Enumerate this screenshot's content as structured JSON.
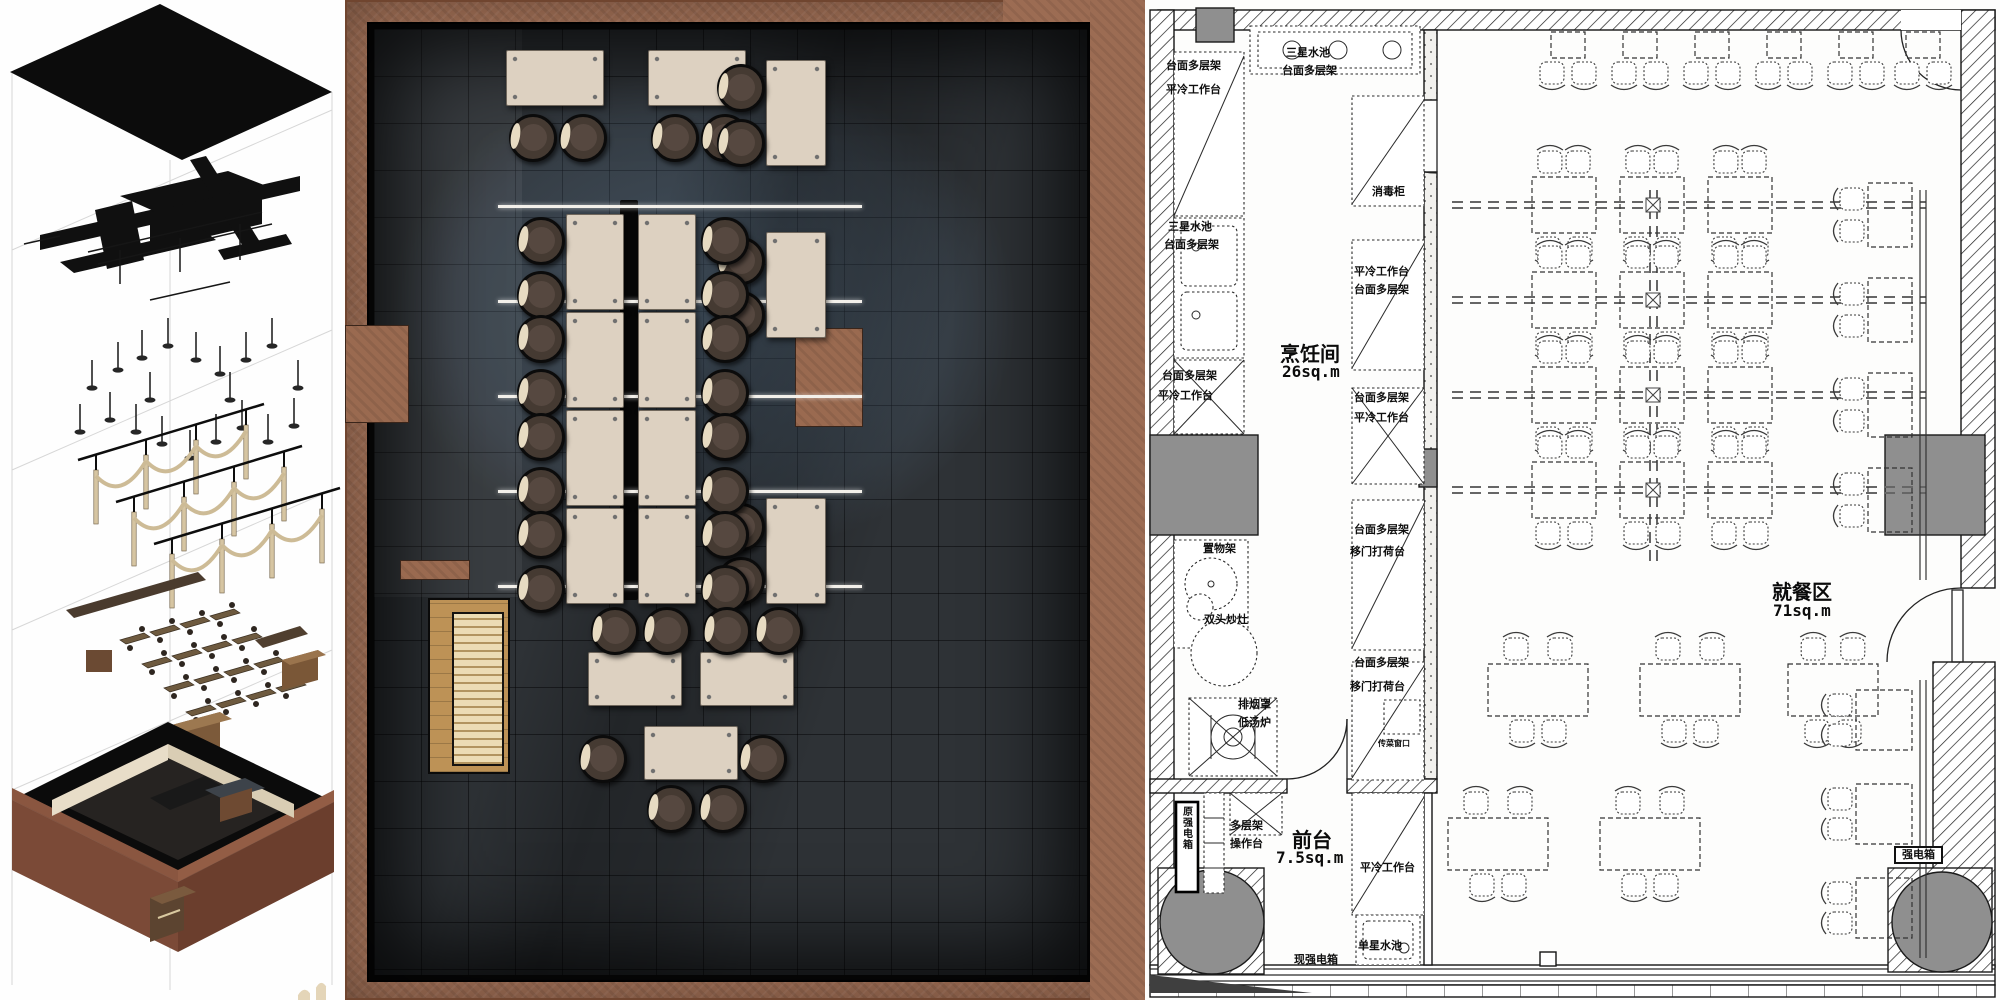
{
  "board": {
    "description": "restaurant interior design presentation: exploded axonometric, rendered floor plan, technical floor plan",
    "colors": {
      "frame_terracotta": "#9c6c53",
      "render_floor_charcoal": "#2e3236",
      "render_floor_blue": "#4a5a6b",
      "table_cream": "#ddd1c1",
      "stool_brown": "#453a32",
      "wood_floor": "#bd9256",
      "cad_line": "#1a1a1a",
      "cad_column_gray": "#8f8f8f"
    }
  },
  "panels": {
    "axon": {
      "name": "exploded-axonometric-diagram",
      "layers": [
        "ceiling-plane",
        "mep-ductwork",
        "pendant-lights",
        "timber-arch-structure",
        "furniture",
        "building-shell"
      ],
      "lights": [
        [
          92,
          360
        ],
        [
          118,
          342
        ],
        [
          142,
          330
        ],
        [
          168,
          318
        ],
        [
          196,
          332
        ],
        [
          220,
          346
        ],
        [
          246,
          332
        ],
        [
          272,
          318
        ],
        [
          110,
          392
        ],
        [
          136,
          404
        ],
        [
          162,
          416
        ],
        [
          190,
          430
        ],
        [
          216,
          414
        ],
        [
          242,
          400
        ],
        [
          268,
          414
        ],
        [
          294,
          398
        ],
        [
          150,
          372
        ],
        [
          230,
          372
        ],
        [
          80,
          404
        ],
        [
          298,
          360
        ]
      ]
    },
    "render_plan": {
      "name": "rendered-floor-plan",
      "light_lines": {
        "x1": 498,
        "x2": 862,
        "ys": [
          205,
          300,
          395,
          490,
          585
        ]
      },
      "spine_bar": {
        "x": 620,
        "y": 200,
        "w": 18,
        "h": 400
      },
      "stubs": [
        {
          "x": 345,
          "y": 325,
          "w": 62,
          "h": 96
        },
        {
          "x": 795,
          "y": 328,
          "w": 66,
          "h": 97
        },
        {
          "x": 400,
          "y": 560,
          "w": 68,
          "h": 18
        }
      ],
      "wood_zone": {
        "x": 428,
        "y": 598,
        "w": 78,
        "h": 172
      },
      "counter": {
        "x": 452,
        "y": 612,
        "w": 48,
        "h": 150
      },
      "tables": [
        {
          "x": 506,
          "y": 50,
          "w": 96,
          "h": 54
        },
        {
          "x": 648,
          "y": 50,
          "w": 96,
          "h": 54
        },
        {
          "x": 766,
          "y": 60,
          "w": 58,
          "h": 104
        },
        {
          "x": 766,
          "y": 232,
          "w": 58,
          "h": 104
        },
        {
          "x": 766,
          "y": 498,
          "w": 58,
          "h": 104
        },
        {
          "x": 566,
          "y": 214,
          "w": 56,
          "h": 94
        },
        {
          "x": 566,
          "y": 312,
          "w": 56,
          "h": 94
        },
        {
          "x": 566,
          "y": 410,
          "w": 56,
          "h": 94
        },
        {
          "x": 566,
          "y": 508,
          "w": 56,
          "h": 94
        },
        {
          "x": 638,
          "y": 214,
          "w": 56,
          "h": 94
        },
        {
          "x": 638,
          "y": 312,
          "w": 56,
          "h": 94
        },
        {
          "x": 638,
          "y": 410,
          "w": 56,
          "h": 94
        },
        {
          "x": 638,
          "y": 508,
          "w": 56,
          "h": 94
        },
        {
          "x": 588,
          "y": 652,
          "w": 92,
          "h": 52
        },
        {
          "x": 700,
          "y": 652,
          "w": 92,
          "h": 52
        },
        {
          "x": 644,
          "y": 726,
          "w": 92,
          "h": 52
        }
      ],
      "stools": [
        [
          530,
          135
        ],
        [
          580,
          135
        ],
        [
          672,
          135
        ],
        [
          722,
          135
        ],
        [
          738,
          85
        ],
        [
          738,
          140
        ],
        [
          738,
          258
        ],
        [
          738,
          312
        ],
        [
          738,
          524
        ],
        [
          738,
          578
        ],
        [
          538,
          238
        ],
        [
          538,
          292
        ],
        [
          538,
          336
        ],
        [
          538,
          390
        ],
        [
          538,
          434
        ],
        [
          538,
          488
        ],
        [
          538,
          532
        ],
        [
          538,
          586
        ],
        [
          722,
          238
        ],
        [
          722,
          292
        ],
        [
          722,
          336
        ],
        [
          722,
          390
        ],
        [
          722,
          434
        ],
        [
          722,
          488
        ],
        [
          722,
          532
        ],
        [
          722,
          586
        ],
        [
          612,
          628
        ],
        [
          664,
          628
        ],
        [
          724,
          628
        ],
        [
          776,
          628
        ],
        [
          600,
          756
        ],
        [
          760,
          756
        ],
        [
          668,
          806
        ],
        [
          720,
          806
        ]
      ]
    },
    "cad_plan": {
      "name": "technical-floor-plan",
      "rooms": [
        {
          "label": "烹饪间",
          "area": "26sq.m",
          "x": 1280,
          "y": 338
        },
        {
          "label": "就餐区",
          "area": "71sq.m",
          "x": 1772,
          "y": 576
        },
        {
          "label": "前台",
          "area": "7.5sq.m",
          "x": 1292,
          "y": 824
        }
      ],
      "labels": [
        {
          "text": "台面多层架",
          "x": 1166,
          "y": 60
        },
        {
          "text": "平冷工作台",
          "x": 1166,
          "y": 84
        },
        {
          "text": "三星水池",
          "x": 1286,
          "y": 47
        },
        {
          "text": "台面多层架",
          "x": 1282,
          "y": 65
        },
        {
          "text": "消毒柜",
          "x": 1372,
          "y": 186
        },
        {
          "text": "三星水池",
          "x": 1168,
          "y": 221
        },
        {
          "text": "台面多层架",
          "x": 1164,
          "y": 239
        },
        {
          "text": "平冷工作台",
          "x": 1354,
          "y": 266
        },
        {
          "text": "台面多层架",
          "x": 1354,
          "y": 284
        },
        {
          "text": "台面多层架",
          "x": 1162,
          "y": 370
        },
        {
          "text": "平冷工作台",
          "x": 1158,
          "y": 390
        },
        {
          "text": "台面多层架",
          "x": 1354,
          "y": 392
        },
        {
          "text": "平冷工作台",
          "x": 1354,
          "y": 412
        },
        {
          "text": "置物架",
          "x": 1203,
          "y": 543
        },
        {
          "text": "台面多层架",
          "x": 1354,
          "y": 524
        },
        {
          "text": "移门打荷台",
          "x": 1350,
          "y": 546
        },
        {
          "text": "双头炒灶",
          "x": 1204,
          "y": 614
        },
        {
          "text": "排烟罩",
          "x": 1238,
          "y": 699
        },
        {
          "text": "低汤炉",
          "x": 1238,
          "y": 717
        },
        {
          "text": "台面多层架",
          "x": 1354,
          "y": 657
        },
        {
          "text": "移门打荷台",
          "x": 1350,
          "y": 681
        },
        {
          "text": "传菜窗口",
          "x": 1378,
          "y": 740,
          "size": 8
        },
        {
          "text": "原强电箱",
          "x": 1180,
          "y": 806,
          "vertical": true,
          "size": 10
        },
        {
          "text": "多层架",
          "x": 1230,
          "y": 820
        },
        {
          "text": "操作台",
          "x": 1230,
          "y": 838
        },
        {
          "text": "平冷工作台",
          "x": 1360,
          "y": 862
        },
        {
          "text": "单星水池",
          "x": 1358,
          "y": 940
        },
        {
          "text": "现强电箱",
          "x": 1294,
          "y": 954
        },
        {
          "text": "强电箱",
          "x": 1894,
          "y": 846,
          "cls": "boxed"
        }
      ],
      "dining": {
        "lines": {
          "x1": 1452,
          "x2": 1926,
          "ys": [
            205,
            300,
            395,
            490
          ]
        },
        "spine": {
          "x": 1653,
          "y1": 190,
          "y2": 566
        },
        "bench_lines": [
          {
            "x": 1920,
            "y1": 190,
            "y2": 580
          },
          {
            "x": 1926,
            "y1": 190,
            "y2": 580
          },
          {
            "x": 1920,
            "y1": 680,
            "y2": 958
          },
          {
            "x": 1926,
            "y1": 680,
            "y2": 958
          }
        ],
        "tables": [
          {
            "x": 1551,
            "y": 32,
            "w": 34,
            "h": 26,
            "s": "b"
          },
          {
            "x": 1623,
            "y": 32,
            "w": 34,
            "h": 26,
            "s": "b"
          },
          {
            "x": 1695,
            "y": 32,
            "w": 34,
            "h": 26,
            "s": "b"
          },
          {
            "x": 1767,
            "y": 32,
            "w": 34,
            "h": 26,
            "s": "b"
          },
          {
            "x": 1839,
            "y": 32,
            "w": 34,
            "h": 26,
            "s": "b"
          },
          {
            "x": 1906,
            "y": 32,
            "w": 34,
            "h": 26,
            "s": "b"
          },
          {
            "x": 1532,
            "y": 177,
            "w": 64,
            "h": 56,
            "s": "tb"
          },
          {
            "x": 1620,
            "y": 177,
            "w": 64,
            "h": 56,
            "s": "tb"
          },
          {
            "x": 1708,
            "y": 177,
            "w": 64,
            "h": 56,
            "s": "tb"
          },
          {
            "x": 1532,
            "y": 272,
            "w": 64,
            "h": 56,
            "s": "tb"
          },
          {
            "x": 1620,
            "y": 272,
            "w": 64,
            "h": 56,
            "s": "tb"
          },
          {
            "x": 1708,
            "y": 272,
            "w": 64,
            "h": 56,
            "s": "tb"
          },
          {
            "x": 1532,
            "y": 367,
            "w": 64,
            "h": 56,
            "s": "tb"
          },
          {
            "x": 1620,
            "y": 367,
            "w": 64,
            "h": 56,
            "s": "tb"
          },
          {
            "x": 1708,
            "y": 367,
            "w": 64,
            "h": 56,
            "s": "tb"
          },
          {
            "x": 1532,
            "y": 462,
            "w": 64,
            "h": 56,
            "s": "tb"
          },
          {
            "x": 1620,
            "y": 462,
            "w": 64,
            "h": 56,
            "s": "tb"
          },
          {
            "x": 1708,
            "y": 462,
            "w": 64,
            "h": 56,
            "s": "tb"
          },
          {
            "x": 1868,
            "y": 183,
            "w": 44,
            "h": 64,
            "s": "l"
          },
          {
            "x": 1868,
            "y": 278,
            "w": 44,
            "h": 64,
            "s": "l"
          },
          {
            "x": 1868,
            "y": 373,
            "w": 44,
            "h": 64,
            "s": "l"
          },
          {
            "x": 1868,
            "y": 468,
            "w": 44,
            "h": 64,
            "s": "l"
          },
          {
            "x": 1488,
            "y": 664,
            "w": 100,
            "h": 52,
            "s": "tb"
          },
          {
            "x": 1640,
            "y": 664,
            "w": 100,
            "h": 52,
            "s": "tb"
          },
          {
            "x": 1788,
            "y": 664,
            "w": 90,
            "h": 52,
            "s": "tb"
          },
          {
            "x": 1448,
            "y": 818,
            "w": 100,
            "h": 52,
            "s": "tb"
          },
          {
            "x": 1600,
            "y": 818,
            "w": 100,
            "h": 52,
            "s": "tb"
          },
          {
            "x": 1856,
            "y": 690,
            "w": 56,
            "h": 60,
            "s": "l"
          },
          {
            "x": 1856,
            "y": 784,
            "w": 56,
            "h": 60,
            "s": "l"
          },
          {
            "x": 1856,
            "y": 878,
            "w": 56,
            "h": 60,
            "s": "l"
          }
        ]
      }
    }
  }
}
